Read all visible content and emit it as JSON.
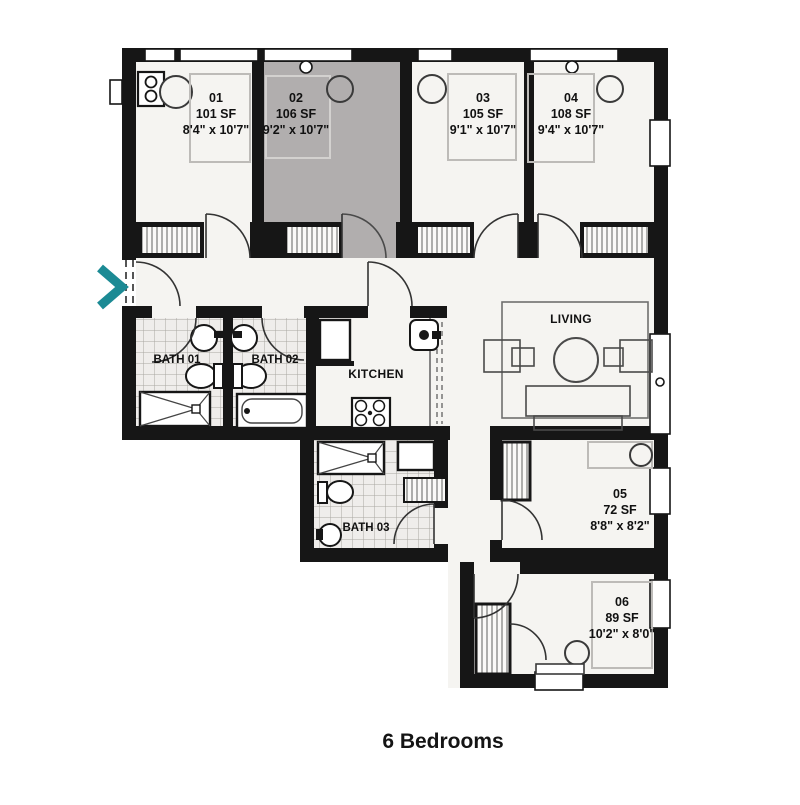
{
  "plan": {
    "caption": "6 Bedrooms",
    "bedrooms": [
      {
        "id": "01",
        "sf": "101 SF",
        "dims": "8'4\" x 10'7\"",
        "highlighted": false
      },
      {
        "id": "02",
        "sf": "106 SF",
        "dims": "9'2\" x 10'7\"",
        "highlighted": true
      },
      {
        "id": "03",
        "sf": "105 SF",
        "dims": "9'1\" x 10'7\"",
        "highlighted": false
      },
      {
        "id": "04",
        "sf": "108 SF",
        "dims": "9'4\" x 10'7\"",
        "highlighted": false
      },
      {
        "id": "05",
        "sf": "72 SF",
        "dims": "8'8\" x 8'2\"",
        "highlighted": false
      },
      {
        "id": "06",
        "sf": "89 SF",
        "dims": "10'2\" x 8'0\"",
        "highlighted": false
      }
    ],
    "zones": {
      "bath1": "BATH 01",
      "bath2": "BATH 02",
      "bath3": "BATH 03",
      "kitchen": "KITCHEN",
      "living": "LIVING"
    },
    "colors": {
      "wall": "#161616",
      "floor": "#f5f4f1",
      "highlight": "#b1aeae",
      "accent": "#1b8a94"
    }
  }
}
